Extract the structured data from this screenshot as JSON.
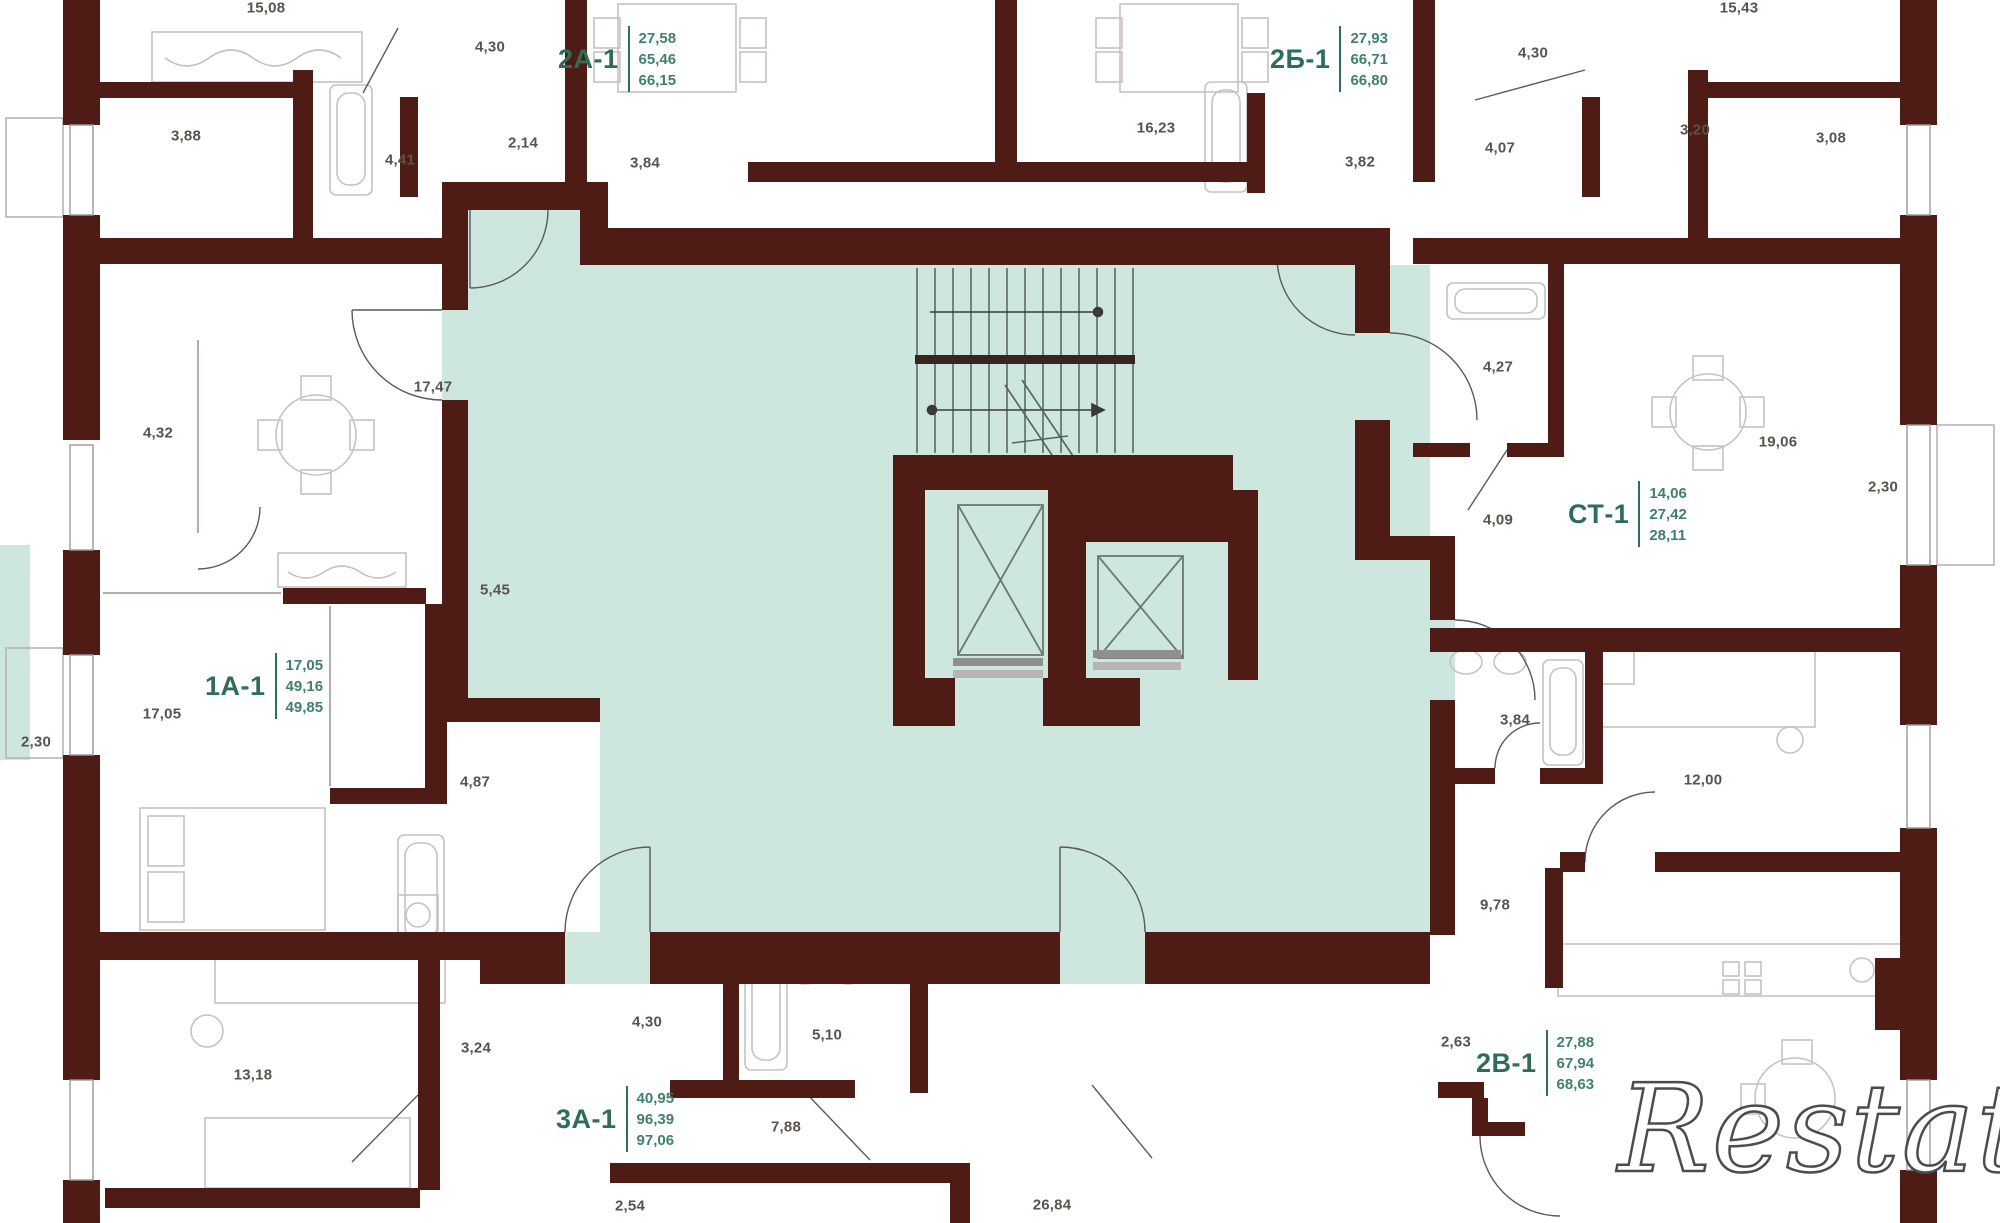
{
  "watermark": "Restate",
  "apartments": [
    {
      "code": "2А-1",
      "areas": [
        "27,58",
        "65,46",
        "66,15"
      ]
    },
    {
      "code": "2Б-1",
      "areas": [
        "27,93",
        "66,71",
        "66,80"
      ]
    },
    {
      "code": "1А-1",
      "areas": [
        "17,05",
        "49,16",
        "49,85"
      ]
    },
    {
      "code": "СТ-1",
      "areas": [
        "14,06",
        "27,42",
        "28,11"
      ]
    },
    {
      "code": "3А-1",
      "areas": [
        "40,95",
        "96,39",
        "97,06"
      ]
    },
    {
      "code": "2В-1",
      "areas": [
        "27,88",
        "67,94",
        "68,63"
      ]
    }
  ],
  "dimensions": [
    "15,08",
    "4,30",
    "3,88",
    "4,41",
    "2,14",
    "3,84",
    "16,23",
    "3,82",
    "4,07",
    "4,30",
    "3,20",
    "3,08",
    "15,43",
    "17,47",
    "4,32",
    "5,45",
    "17,05",
    "2,30",
    "4,87",
    "4,27",
    "19,06",
    "2,30",
    "4,09",
    "3,84",
    "12,00",
    "9,78",
    "13,18",
    "3,24",
    "4,30",
    "5,10",
    "7,88",
    "2,54",
    "26,84",
    "2,63"
  ],
  "colors": {
    "wall": "#4e1c15",
    "common_area": "#cde7df",
    "label_green": "#2e6e57",
    "dim_text": "#5a534c"
  }
}
